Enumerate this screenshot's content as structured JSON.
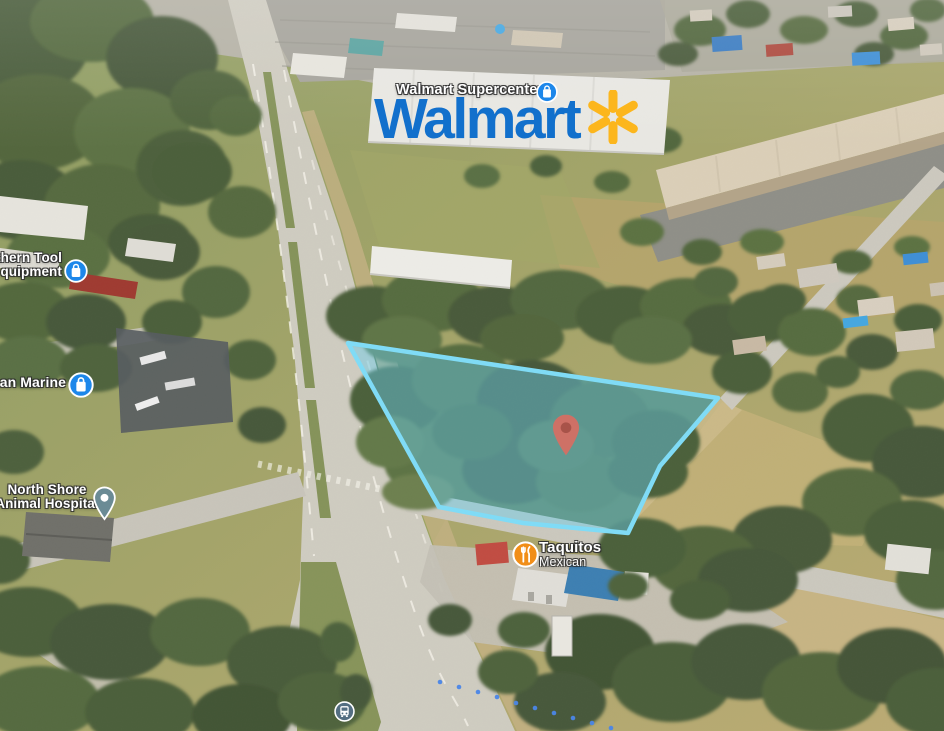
{
  "view": {
    "type": "3d-aerial-satellite-map",
    "description": "Oblique aerial imagery with highlighted vacant land parcel near Walmart Supercenter"
  },
  "parcel": {
    "points": "348,343 718,398 660,466 628,533 523,523 439,507",
    "fill": "rgba(105,206,238,0.45)",
    "stroke": "#7fdcf7",
    "pin_color": "#df6b60",
    "pin_inner_color": "#b3493f"
  },
  "logo": {
    "wordmark": "Walmart",
    "blue": "#1270cc",
    "spark_yellow": "#fcb61d"
  },
  "pois": {
    "walmart": {
      "label": "Walmart Supercenter",
      "icon": "shopping-bag",
      "icon_color": "#1d87ea"
    },
    "southern_tool": {
      "line1": "thern Tool",
      "line2": "quipment",
      "icon": "shopping-bag",
      "icon_color": "#1d87ea"
    },
    "marine": {
      "label": "man Marine",
      "icon": "shopping-bag",
      "icon_color": "#1d87ea"
    },
    "north_shore": {
      "line1": "North Shore",
      "line2": "Animal Hospital",
      "icon": "place-pin",
      "icon_color": "#6b8b95"
    },
    "taquitos": {
      "line1": "Taquitos",
      "line2": "Mexican",
      "icon": "restaurant",
      "icon_color": "#f18e18"
    },
    "transit": {
      "icon": "bus",
      "icon_color": "#546e82"
    }
  }
}
